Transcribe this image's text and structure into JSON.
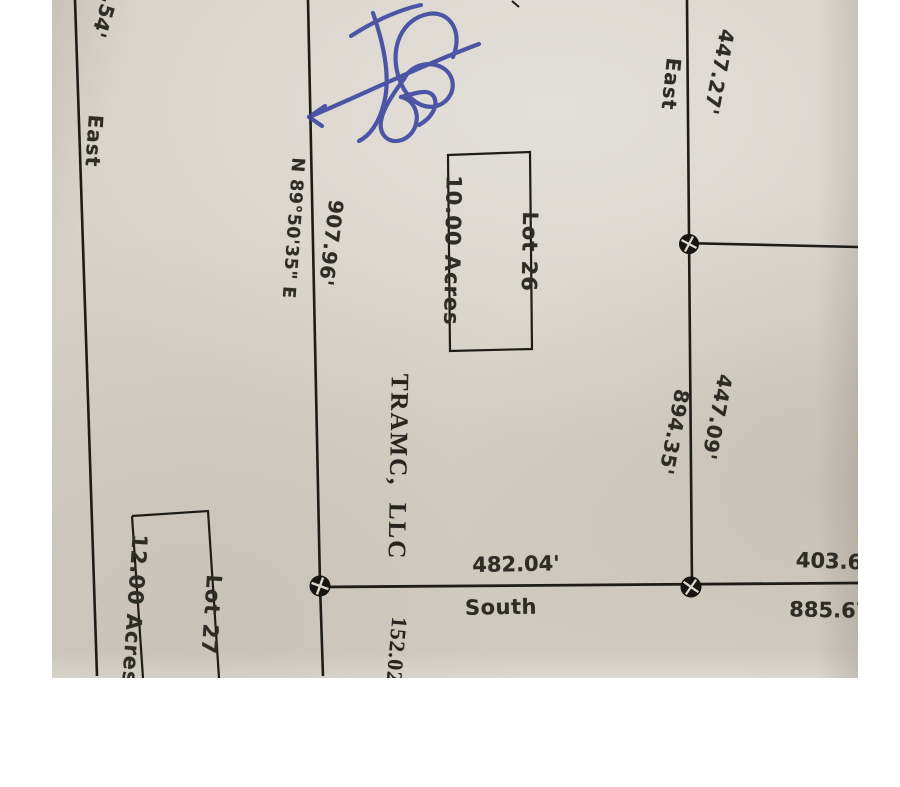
{
  "photo": {
    "paper_color": "#d6d1c8",
    "ink_color": "#1d1c19",
    "pen_ink_color": "#3d47a0",
    "icons": {
      "survey_monument": "filled-circle-with-cross"
    }
  },
  "plat": {
    "lot26": {
      "name": "Lot 26",
      "acreage": "10.00 Acres"
    },
    "lot27": {
      "name": "Lot 27",
      "acreage": "12.00 Acres"
    },
    "owner": "TRAMC,  LLC",
    "bearings": {
      "west_line": "N 89°50'35\" E"
    },
    "directions": {
      "west_line": "East",
      "north_spur": "East",
      "south_line": "South"
    },
    "dimensions": {
      "partial_top_left": ".54'",
      "west_line": "907.96'",
      "north_spur": "447.27'",
      "east_line_inner": "894.35'",
      "east_line_outer": "447.09'",
      "south_line_inner": "482.04'",
      "south_line_outer_top": "403.6",
      "south_line_outer_bottom": "885.67'",
      "partial_bottom": "152.02"
    }
  }
}
